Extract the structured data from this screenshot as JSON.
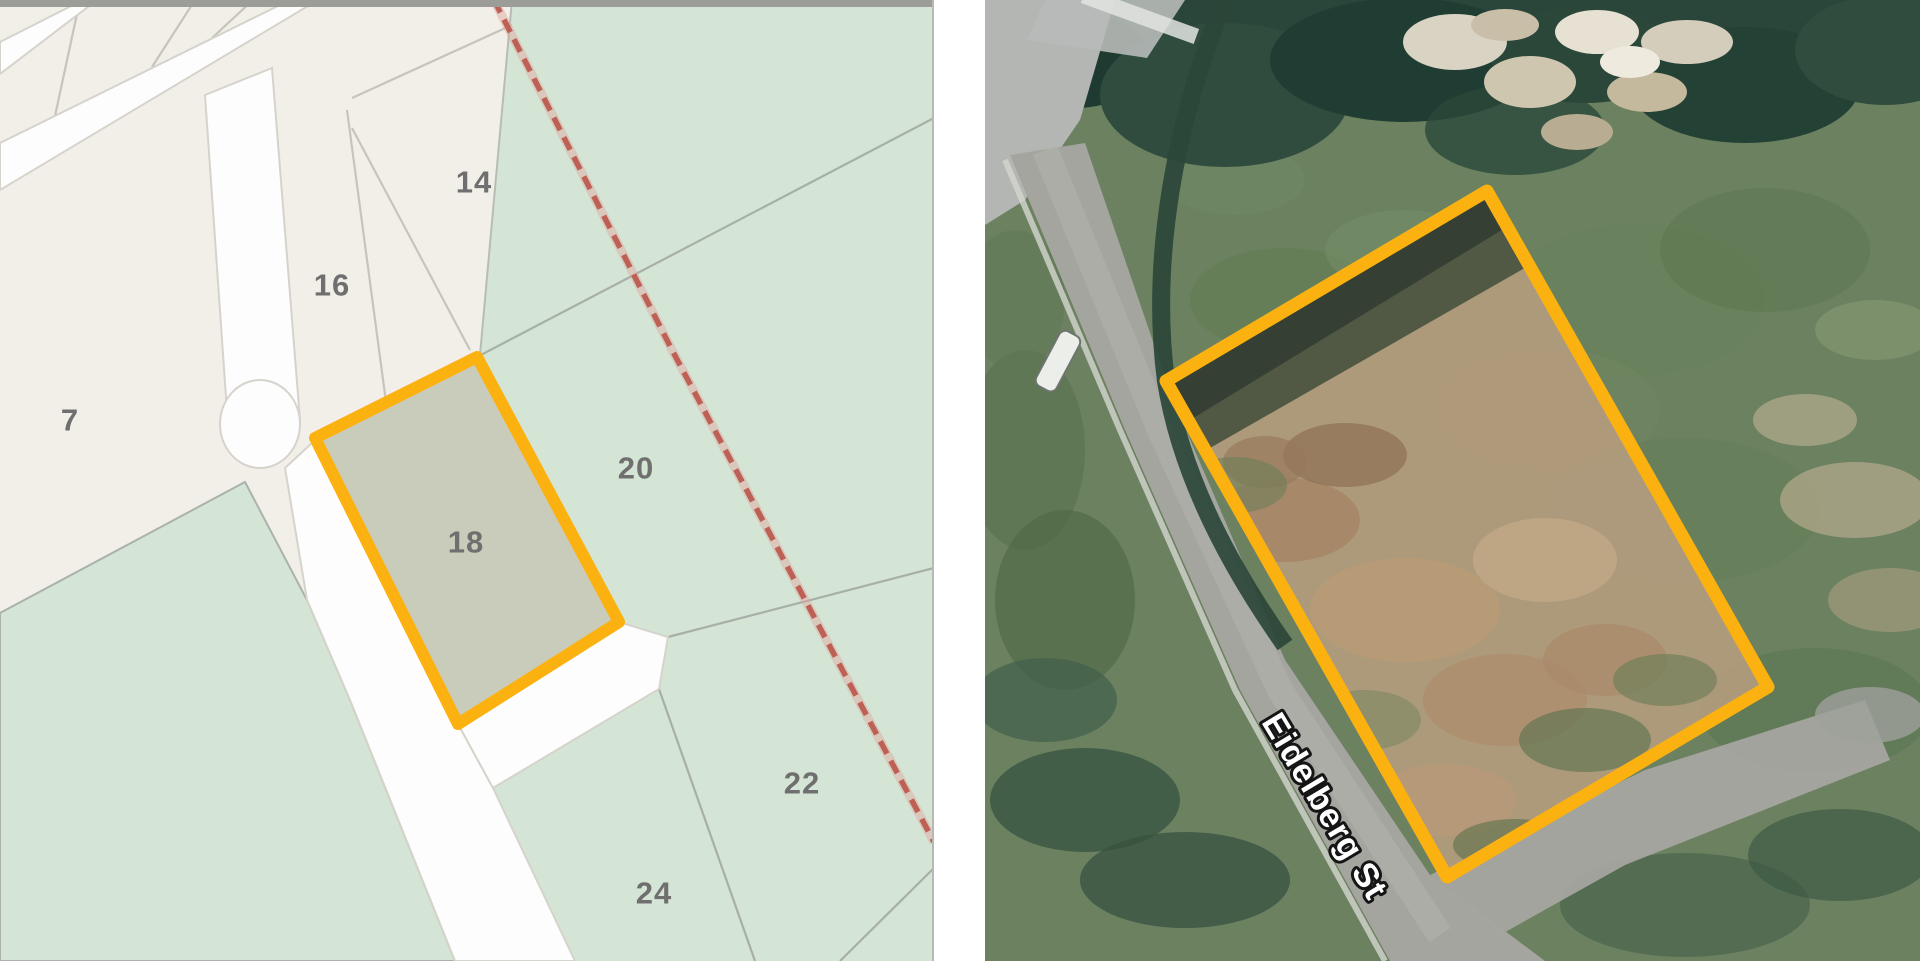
{
  "figure": {
    "description": "Side-by-side cadastral map and aerial photograph with Lot 18 highlighted"
  },
  "map_panel": {
    "highlighted_lot": "18",
    "highlight_color": "#FBB211",
    "boundary_line_color": "#BD6055",
    "label_color": "#6F6F6F",
    "lot_labels": [
      {
        "id": "7",
        "x": 70,
        "y": 420
      },
      {
        "id": "14",
        "x": 474,
        "y": 182
      },
      {
        "id": "16",
        "x": 332,
        "y": 285
      },
      {
        "id": "18",
        "x": 466,
        "y": 542
      },
      {
        "id": "20",
        "x": 636,
        "y": 468
      },
      {
        "id": "22",
        "x": 802,
        "y": 783
      },
      {
        "id": "24",
        "x": 654,
        "y": 893
      }
    ],
    "colors": {
      "parcel_cream": "#F1EFE8",
      "parcel_green": "#D4E5D6",
      "lot18_fill": "#C9CCBA",
      "road_white": "#FDFDFD"
    }
  },
  "aerial_panel": {
    "street_label": "Eidelberg St",
    "highlight_color": "#FBB211"
  }
}
